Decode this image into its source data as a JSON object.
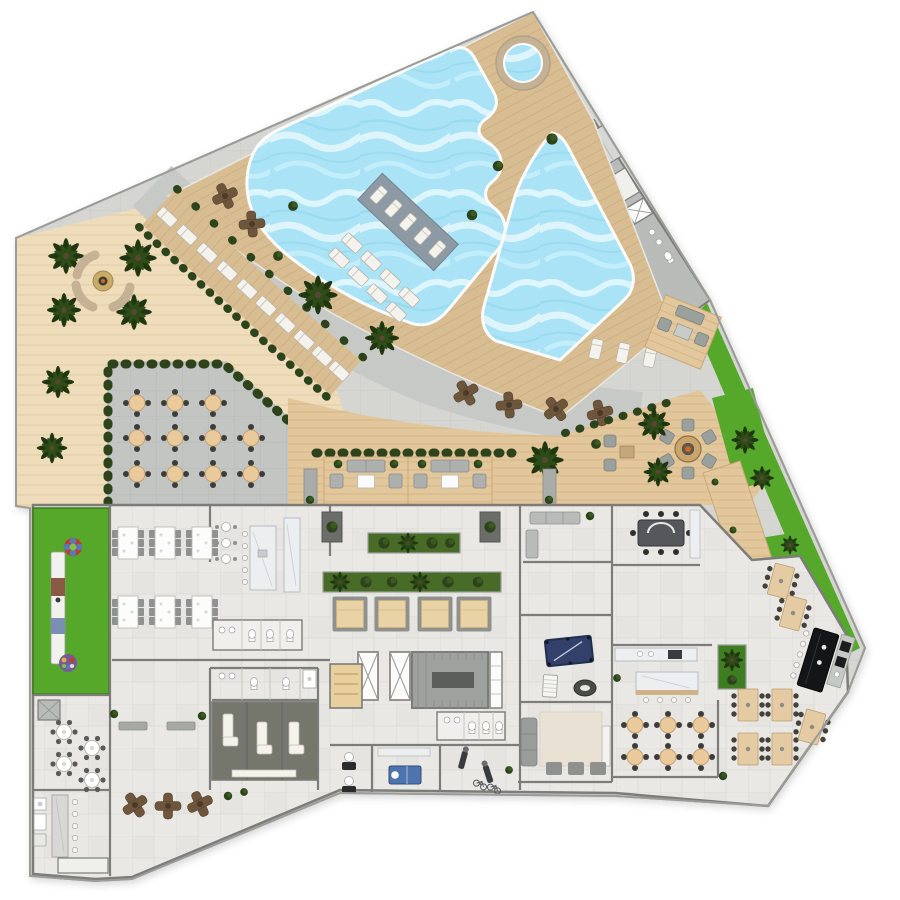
{
  "title": "Resort amenity deck floor plan (top-down rendering)",
  "canvas": {
    "width": 900,
    "height": 900
  },
  "visible_text": [],
  "palette": {
    "background": "#ffffff",
    "paving": "#d5d6d2",
    "walkway": "#c7c9c6",
    "terrace_paving": "#c2c5c2",
    "pool_deck_wood": "#d9bd92",
    "pool_deck_wood_line": "#c6a273",
    "light_wood_field": "#eedcba",
    "light_wood_line": "#e1cba2",
    "low_deck_wood": "#e3c79c",
    "low_deck_line": "#d3b281",
    "water": "#a9e3f5",
    "water_highlight": "#eefbff",
    "lawn": "#55a82a",
    "hedge": "#2c431b",
    "palm_foliage": "#1f3610",
    "interior_floor": "#e9e8e4",
    "interior_line": "#dcdbd6",
    "wall": "#7c7c78",
    "marble": "#eceef0",
    "furniture_white": "#f4f2ec",
    "furniture_gray": "#9a9c99",
    "wood_furniture": "#e5cba3",
    "dark_table": "#6e563c",
    "pool_table": "#32406b",
    "massage_table": "#4f74ad",
    "bar_counter": "#141517",
    "stair_core": "#9fa19e",
    "spa_floor": "#75766c",
    "shelf_gray": "#8d99a3",
    "stone": "#c5b193",
    "service_gray": "#b9bbb8",
    "play_red": "#c23b2e",
    "play_blue": "#5b79b3"
  },
  "outdoor_areas": [
    {
      "name": "circular-spa",
      "shape": "round",
      "stone_ring": true
    },
    {
      "name": "main-pool",
      "shape": "freeform",
      "scalloped_edges": 2,
      "tanning_shelf_loungers": 5
    },
    {
      "name": "second-pool",
      "shape": "angled"
    },
    {
      "name": "upper-pool-deck",
      "deck_loungers": 8,
      "poolside_bushes": 5,
      "cafe_cross_tables": 2
    },
    {
      "name": "service-core-top",
      "rooms": 2,
      "elevator": 1,
      "wc_fixtures": 3
    },
    {
      "name": "curved-lounger-terrace",
      "loungers": 10,
      "hedge_rows": 2
    },
    {
      "name": "palm-garden",
      "palm_trees": 6,
      "fire_feature_benches": 2
    },
    {
      "name": "outdoor-dining-terrace",
      "round_tables": 11,
      "seats_per_table": 4,
      "hedge_border": true
    },
    {
      "name": "promenade",
      "cross_tables": 4,
      "palms": 3
    },
    {
      "name": "lounge-cabanas",
      "count": 2,
      "each": {
        "sofa": 1,
        "armchairs": 2,
        "coffee_table": 1,
        "planters": 2
      }
    },
    {
      "name": "fire-pit-lounge",
      "chairs": 6,
      "side_chat_set": {
        "chairs": 2,
        "table": 1
      },
      "trees": 2
    },
    {
      "name": "chat-nook",
      "loveseat": 1,
      "armchairs": 2,
      "table": 1
    },
    {
      "name": "poolside-loungers-east",
      "loungers": 3
    },
    {
      "name": "east-lawn",
      "patches": 3,
      "trees": 5
    },
    {
      "name": "boardwalk-east",
      "material": "wood"
    },
    {
      "name": "playground-lawn",
      "carousel": 1,
      "play_structure": 1,
      "mosaic_flower": 1
    },
    {
      "name": "bbq-terrace",
      "cross_tables": 3,
      "plants": 2
    }
  ],
  "interior_rooms": [
    {
      "name": "party-room",
      "rect_tables": 6,
      "seats_per_table": 6
    },
    {
      "name": "catering-kitchen",
      "island": 1,
      "counter": 1,
      "bar_tables": 3
    },
    {
      "name": "restrooms-north",
      "sinks": 2,
      "toilets": 3
    },
    {
      "name": "planter-court",
      "long_planters": 2,
      "square_planters": 2,
      "daybeds": 4
    },
    {
      "name": "lounge-room",
      "sofa": 1,
      "bench": 1,
      "plant": 1
    },
    {
      "name": "private-dining",
      "table": 1,
      "chairs": 8
    },
    {
      "name": "games-room",
      "billiards_table": 1,
      "foosball_table": 1,
      "card_table": 1
    },
    {
      "name": "media-lounge",
      "sofa": 1,
      "ottomans": 3,
      "rug": 1,
      "tv_console": 1
    },
    {
      "name": "club-kitchen-dining",
      "counter": 1,
      "island": 1,
      "round_tables": 6,
      "seats_per_table": 4
    },
    {
      "name": "communal-dining",
      "wood_tables": 5,
      "seats_per_table": 6
    },
    {
      "name": "bar-lounge",
      "bar_counter": 1,
      "bar_stools": 5,
      "back_counter": 1,
      "wood_tables": 2
    },
    {
      "name": "core",
      "elevators": 2,
      "stair_hall": 1,
      "closets": 1
    },
    {
      "name": "sauna",
      "benches": 3
    },
    {
      "name": "treatment-room",
      "massage_table": 1
    },
    {
      "name": "fitness-corner",
      "machines": 2,
      "bicycles": 2
    },
    {
      "name": "reception-stations",
      "count": 2
    },
    {
      "name": "spa-lounge",
      "relax_loungers": 3,
      "shelf": 1
    },
    {
      "name": "spa-restrooms",
      "toilets": 2,
      "sinks": 2,
      "shower": 1
    },
    {
      "name": "card-patio",
      "round_tables": 4,
      "benches": 2,
      "storage_box": 1
    },
    {
      "name": "bar-kitchenette-west",
      "counter_stools": 5,
      "appliances": 3
    }
  ]
}
